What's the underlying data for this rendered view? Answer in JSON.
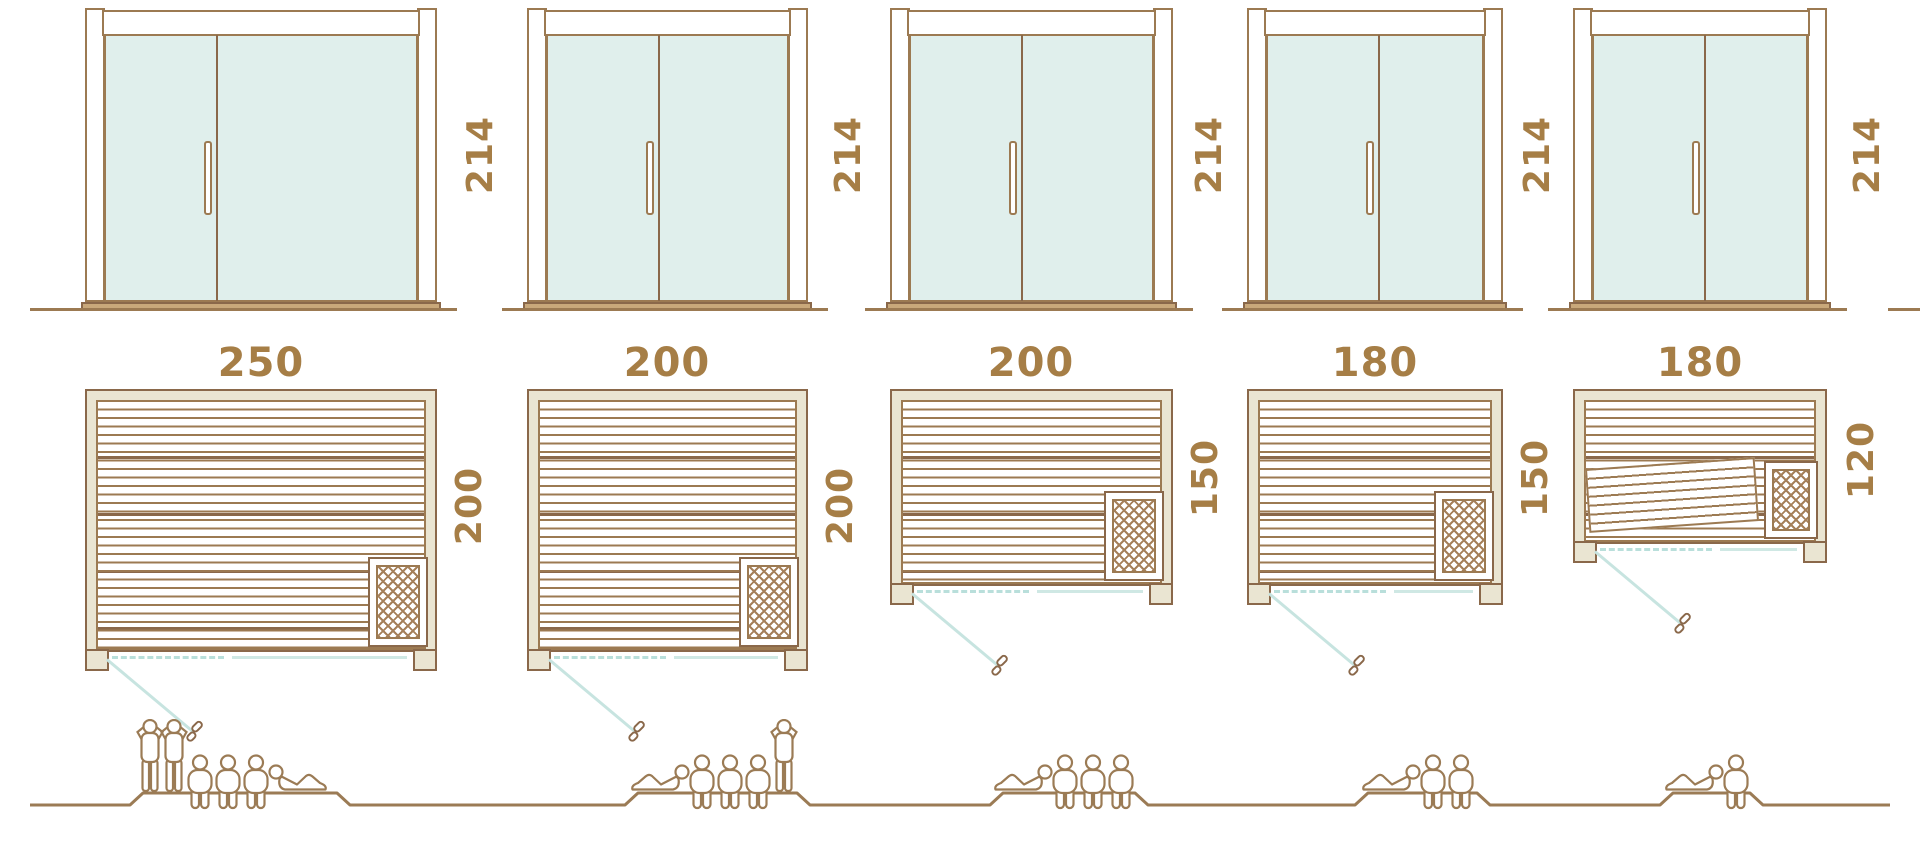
{
  "diagram_title": "Sauna cabin size comparison",
  "units": [
    {
      "name": "sauna-250x200",
      "door_height_cm": "214",
      "width_cm": "250",
      "depth_cm": "200",
      "capacity": 6,
      "people": {
        "standing": 2,
        "seated": 3,
        "lying": 1
      }
    },
    {
      "name": "sauna-200x200",
      "door_height_cm": "214",
      "width_cm": "200",
      "depth_cm": "200",
      "capacity": 5,
      "people": {
        "standing": 1,
        "seated": 3,
        "lying": 1
      }
    },
    {
      "name": "sauna-200x150",
      "door_height_cm": "214",
      "width_cm": "200",
      "depth_cm": "150",
      "capacity": 4,
      "people": {
        "standing": 0,
        "seated": 3,
        "lying": 1
      }
    },
    {
      "name": "sauna-180x150",
      "door_height_cm": "214",
      "width_cm": "180",
      "depth_cm": "150",
      "capacity": 3,
      "people": {
        "standing": 0,
        "seated": 2,
        "lying": 1
      }
    },
    {
      "name": "sauna-180x120",
      "door_height_cm": "214",
      "width_cm": "180",
      "depth_cm": "120",
      "capacity": 2,
      "people": {
        "standing": 0,
        "seated": 1,
        "lying": 1
      }
    }
  ],
  "colors": {
    "line_brown": "#9c7a52",
    "dark_brown": "#8a684a",
    "label_brown": "#a67e46",
    "wall_fill": "#eae5d2",
    "glass": "#e0efec",
    "sill": "#c9a87a",
    "door_swing_teal": "#c7e4e0"
  }
}
